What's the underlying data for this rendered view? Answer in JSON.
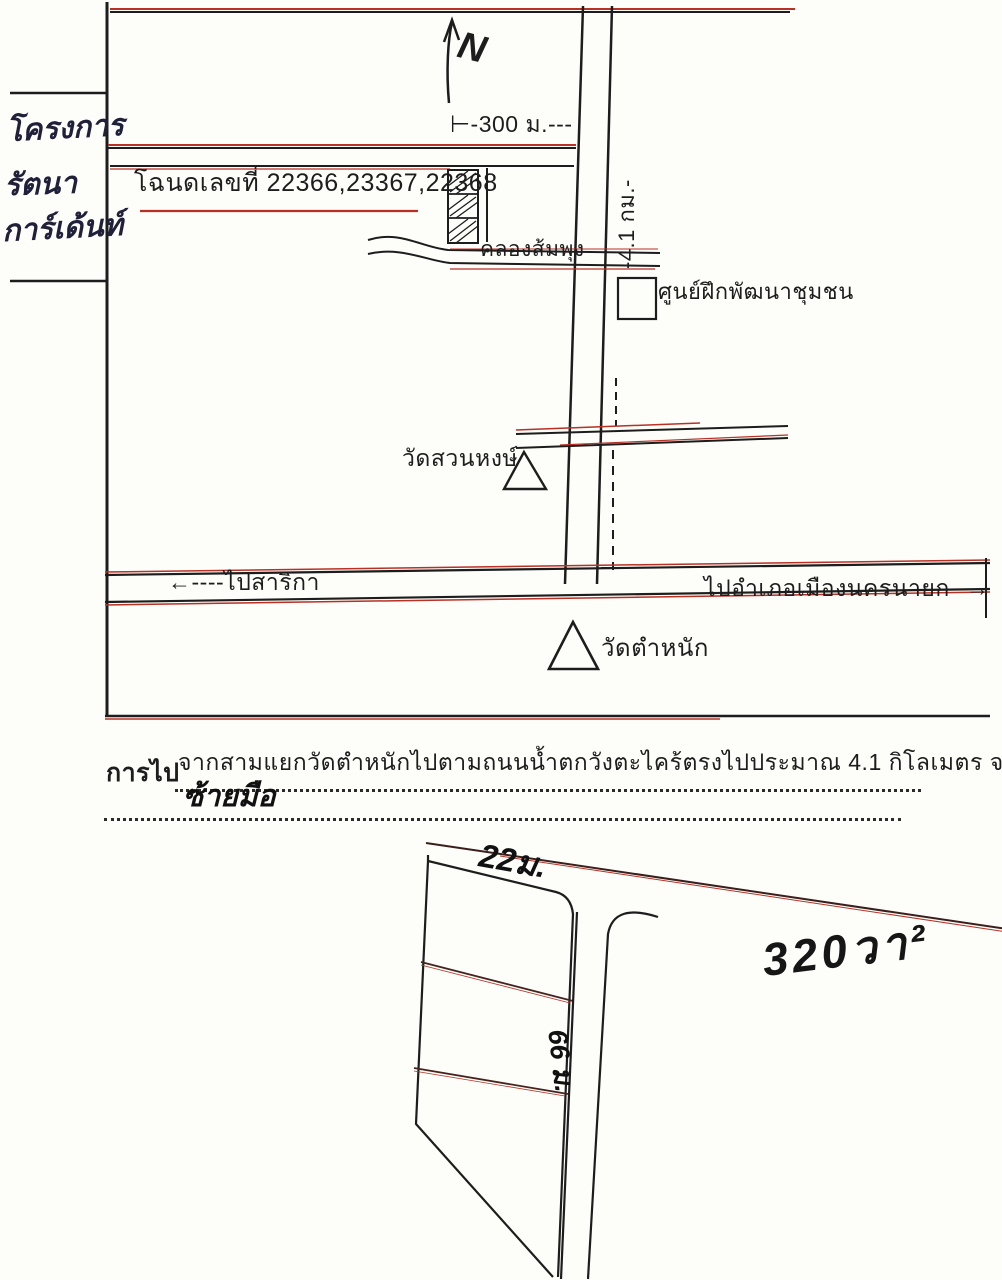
{
  "document_type": "scanned hand-drawn land location map",
  "margin_note": {
    "line1": "โครงการ",
    "line2": "รัตนา",
    "line3": "การ์เด้นท์"
  },
  "map": {
    "north_label": "N",
    "scale_label": "⊢-300 ม.---",
    "deed_label": "โฉนดเลขที่ 22366,23367,22368",
    "distance_label": "-4.1 กม.-",
    "canal_label": "คลองส้มพุง",
    "training_center_label": "ศูนย์ฝึกพัฒนาชุมชน",
    "wat_suan_hong_label": "วัดสวนหงษ์",
    "to_sarika_label": "←----ไปสาริกา",
    "to_mueang_label": "ไปอำเภอเมืองนครนายก--→",
    "wat_tamnak_label": "วัดตำหนัก"
  },
  "directions": {
    "field_label": "การไป",
    "line1": "จากสามแยกวัดตำหนักไปตามถนนน้ำตกวังตะไคร้ตรงไปประมาณ 4.1 กิโลเมตร จะพบทางแยก",
    "line2": "ซ้ายมือ"
  },
  "parcel_sketch": {
    "top_dimension": "22ม.",
    "side_dimension": "66 ม.",
    "area_label": "320วา²"
  },
  "colors": {
    "ink": "#1d1d1d",
    "scan_red": "#b93025",
    "paper": "#fdfdf9"
  }
}
